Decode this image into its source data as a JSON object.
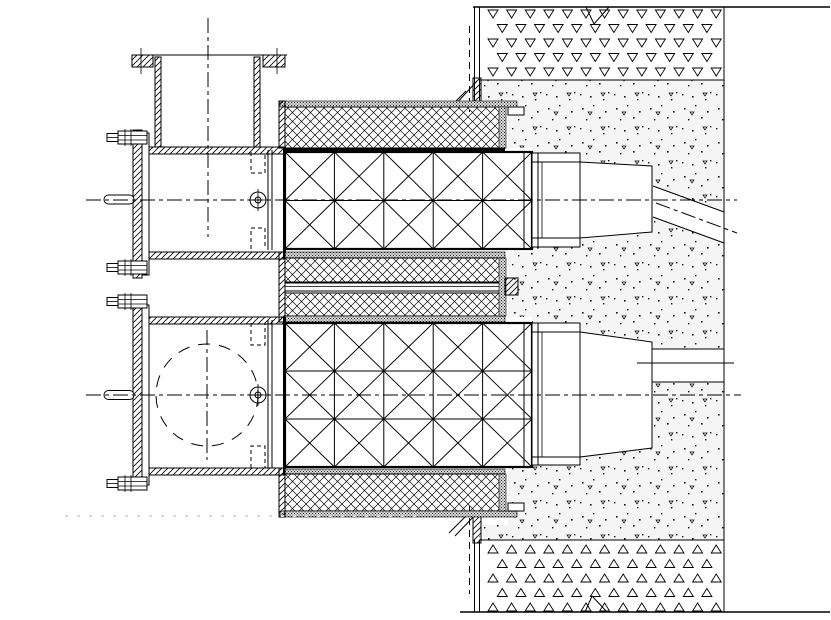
{
  "drawing": {
    "canvas": {
      "width": 831,
      "height": 620
    },
    "colors": {
      "background": "#ffffff",
      "line": "#000000",
      "artifact": "#d9d9d9"
    },
    "truss_grids": [
      {
        "name": "upper",
        "x": 285,
        "y": 152,
        "cols": 5,
        "rows": 2,
        "cell_w": 49.4,
        "cell_h": 48.5
      },
      {
        "name": "lower",
        "x": 285,
        "y": 323,
        "cols": 5,
        "rows": 3,
        "cell_w": 49.4,
        "cell_h": 48
      }
    ],
    "triangle_bands": [
      {
        "name": "top",
        "x0": 488,
        "y0": 10,
        "rows": 5,
        "cols": 13,
        "dx": 18.6,
        "dy": 14.5,
        "stagger": 9.3,
        "tri_w": 10,
        "tri_h": 8,
        "dir": "down"
      },
      {
        "name": "bottom",
        "x0": 488,
        "y0": 545,
        "rows": 5,
        "cols": 13,
        "dx": 18.6,
        "dy": 14.5,
        "stagger": 9.3,
        "tri_w": 10,
        "tri_h": 8,
        "dir": "up"
      }
    ],
    "flange_bolts": [
      {
        "x": 107,
        "y": 131
      },
      {
        "x": 107,
        "y": 261
      },
      {
        "x": 107,
        "y": 295
      },
      {
        "x": 107,
        "y": 477
      }
    ],
    "bolt_symbols": [
      {
        "cx": 258,
        "cy": 200
      },
      {
        "cx": 258,
        "cy": 395
      }
    ],
    "centerlines": {
      "upper_horizontal": {
        "x1": 86,
        "y1": 200,
        "x2": 737,
        "y2": 200
      },
      "lower_horizontal": {
        "x1": 86,
        "y1": 395,
        "x2": 741,
        "y2": 395
      },
      "upper_vertical": {
        "x1": 208,
        "y1": 18,
        "x2": 208,
        "y2": 237
      },
      "lower_vertical": {
        "x1": 207,
        "y1": 330,
        "x2": 207,
        "y2": 460
      },
      "sloped_pipe": {
        "x1": 656,
        "y1": 203,
        "x2": 737,
        "y2": 233
      }
    },
    "dashed_circle": {
      "cx": 207,
      "cy": 395,
      "r": 51
    }
  }
}
